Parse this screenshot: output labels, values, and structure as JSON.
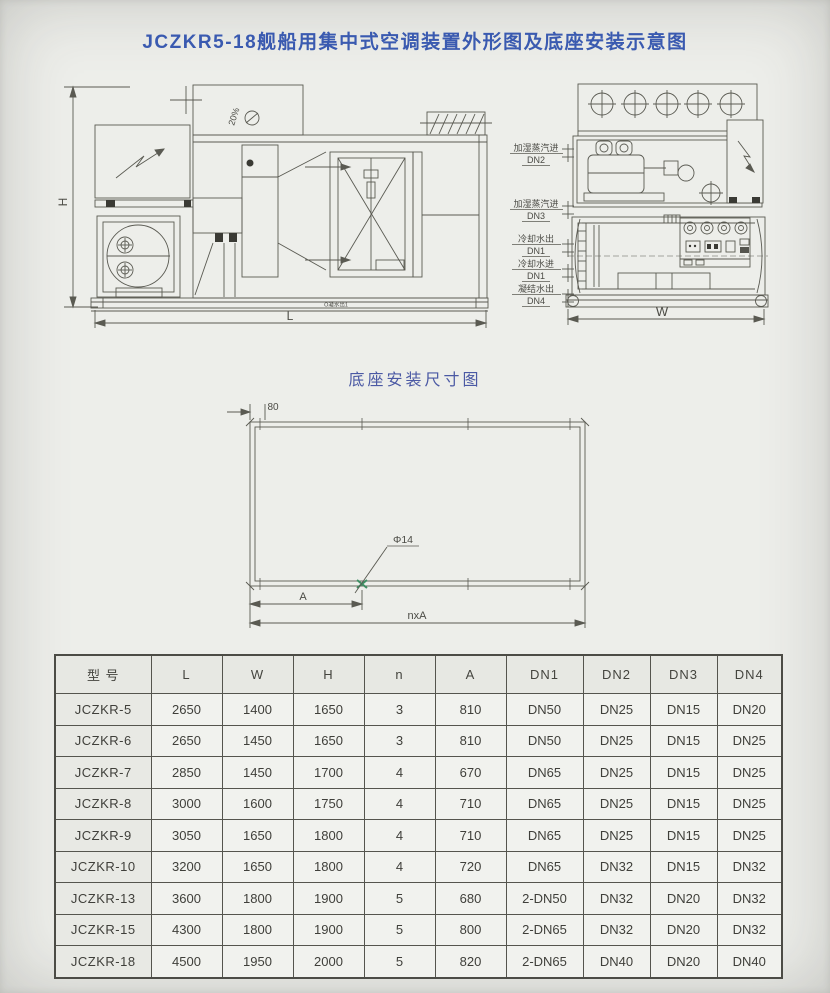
{
  "page": {
    "title": "JCZKR5-18舰船用集中式空调装置外形图及底座安装示意图",
    "accent_color": "#3a5ab0",
    "background_color": "#edeeea"
  },
  "front_view": {
    "h_label": "H",
    "l_label": "L",
    "roof_text": "20%",
    "drain_label": "O凝水出1"
  },
  "side_view": {
    "w_label": "W",
    "ports": [
      {
        "name": "加湿蒸汽进",
        "size": "DN2"
      },
      {
        "name": "加湿蒸汽进",
        "size": "DN3"
      },
      {
        "name": "冷却水出",
        "size": "DN1"
      },
      {
        "name": "冷却水进",
        "size": "DN1"
      },
      {
        "name": "凝结水出",
        "size": "DN4"
      }
    ]
  },
  "base_diagram": {
    "title": "底座安装尺寸图",
    "edge_offset_label": "80",
    "hole_label": "Φ14",
    "pitch_label": "A",
    "total_label": "nxA",
    "hole_mark_color": "#3e8e63"
  },
  "spec_table": {
    "headers": [
      "型 号",
      "L",
      "W",
      "H",
      "n",
      "A",
      "DN1",
      "DN2",
      "DN3",
      "DN4"
    ],
    "rows": [
      [
        "JCZKR-5",
        "2650",
        "1400",
        "1650",
        "3",
        "810",
        "DN50",
        "DN25",
        "DN15",
        "DN20"
      ],
      [
        "JCZKR-6",
        "2650",
        "1450",
        "1650",
        "3",
        "810",
        "DN50",
        "DN25",
        "DN15",
        "DN25"
      ],
      [
        "JCZKR-7",
        "2850",
        "1450",
        "1700",
        "4",
        "670",
        "DN65",
        "DN25",
        "DN15",
        "DN25"
      ],
      [
        "JCZKR-8",
        "3000",
        "1600",
        "1750",
        "4",
        "710",
        "DN65",
        "DN25",
        "DN15",
        "DN25"
      ],
      [
        "JCZKR-9",
        "3050",
        "1650",
        "1800",
        "4",
        "710",
        "DN65",
        "DN25",
        "DN15",
        "DN25"
      ],
      [
        "JCZKR-10",
        "3200",
        "1650",
        "1800",
        "4",
        "720",
        "DN65",
        "DN32",
        "DN15",
        "DN32"
      ],
      [
        "JCZKR-13",
        "3600",
        "1800",
        "1900",
        "5",
        "680",
        "2-DN50",
        "DN32",
        "DN20",
        "DN32"
      ],
      [
        "JCZKR-15",
        "4300",
        "1800",
        "1900",
        "5",
        "800",
        "2-DN65",
        "DN32",
        "DN20",
        "DN32"
      ],
      [
        "JCZKR-18",
        "4500",
        "1950",
        "2000",
        "5",
        "820",
        "2-DN65",
        "DN40",
        "DN20",
        "DN40"
      ]
    ]
  }
}
